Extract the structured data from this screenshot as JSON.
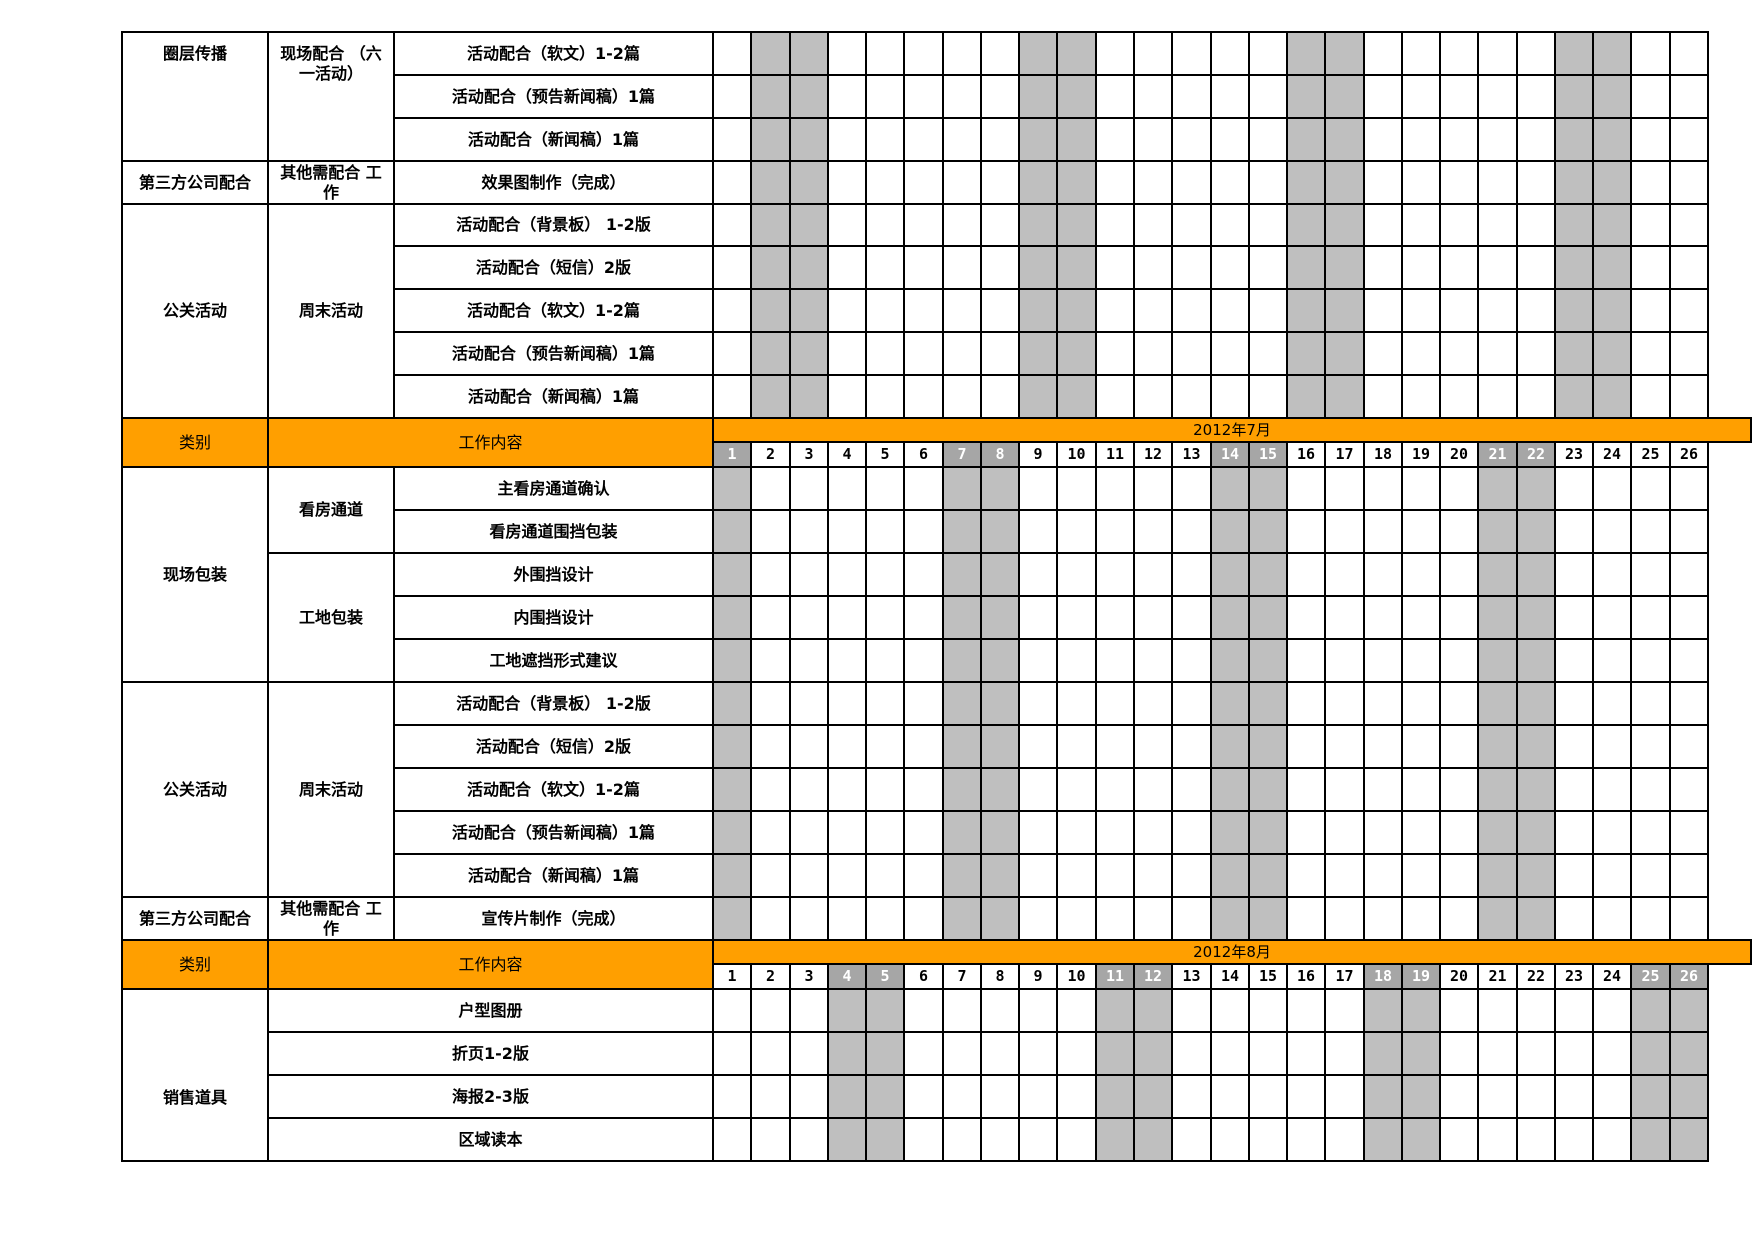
{
  "colors": {
    "header_orange": "#FF9F00",
    "weekend_shade": "#BFBFBF",
    "weekend_number_bg": "#A6A6A6",
    "weekend_number_text": "#FFFFFF",
    "grid_border": "#000000",
    "cell_bg": "#FFFFFF",
    "text": "#000000"
  },
  "days_per_month_shown": 26,
  "sections": [
    {
      "id": "june-body",
      "type": "body",
      "shaded_days": [
        2,
        3,
        9,
        10,
        16,
        17,
        23,
        24
      ],
      "groups": [
        {
          "category": "圈层传播",
          "category_align": "top",
          "subgroups": [
            {
              "label": "现场配合 （六一活动）",
              "align": "top",
              "tasks": [
                "活动配合（软文）1-2篇",
                "活动配合（预告新闻稿）1篇",
                "活动配合（新闻稿）1篇"
              ]
            }
          ]
        },
        {
          "category": "第三方公司配合",
          "subgroups": [
            {
              "label": "其他需配合 工作",
              "tasks": [
                "效果图制作（完成）"
              ]
            }
          ]
        },
        {
          "category": "公关活动",
          "subgroups": [
            {
              "label": "周末活动",
              "tasks": [
                "活动配合（背景板） 1-2版",
                "活动配合（短信）2版",
                "活动配合（软文）1-2篇",
                "活动配合（预告新闻稿）1篇",
                "活动配合（新闻稿）1篇"
              ]
            }
          ]
        }
      ]
    },
    {
      "id": "july-header",
      "type": "header",
      "category_label": "类别",
      "content_label": "工作内容",
      "month_label": "2012年7月",
      "days": [
        1,
        2,
        3,
        4,
        5,
        6,
        7,
        8,
        9,
        10,
        11,
        12,
        13,
        14,
        15,
        16,
        17,
        18,
        19,
        20,
        21,
        22,
        23,
        24,
        25,
        26
      ],
      "weekend_days": [
        1,
        7,
        8,
        14,
        15,
        21,
        22
      ]
    },
    {
      "id": "july-body",
      "type": "body",
      "shaded_days": [
        1,
        7,
        8,
        14,
        15,
        21,
        22
      ],
      "groups": [
        {
          "category": "现场包装",
          "subgroups": [
            {
              "label": "看房通道",
              "tasks": [
                "主看房通道确认",
                "看房通道围挡包装"
              ]
            },
            {
              "label": "工地包装",
              "tasks": [
                "外围挡设计",
                "内围挡设计",
                "工地遮挡形式建议"
              ]
            }
          ]
        },
        {
          "category": "公关活动",
          "subgroups": [
            {
              "label": "周末活动",
              "tasks": [
                "活动配合（背景板） 1-2版",
                "活动配合（短信）2版",
                "活动配合（软文）1-2篇",
                "活动配合（预告新闻稿）1篇",
                "活动配合（新闻稿）1篇"
              ]
            }
          ]
        },
        {
          "category": "第三方公司配合",
          "subgroups": [
            {
              "label": "其他需配合 工作",
              "tasks": [
                "宣传片制作（完成）"
              ]
            }
          ]
        }
      ]
    },
    {
      "id": "august-header",
      "type": "header",
      "category_label": "类别",
      "content_label": "工作内容",
      "month_label": "2012年8月",
      "days": [
        1,
        2,
        3,
        4,
        5,
        6,
        7,
        8,
        9,
        10,
        11,
        12,
        13,
        14,
        15,
        16,
        17,
        18,
        19,
        20,
        21,
        22,
        23,
        24,
        25,
        26
      ],
      "weekend_days": [
        4,
        5,
        11,
        12,
        18,
        19,
        25,
        26
      ]
    },
    {
      "id": "august-body",
      "type": "body",
      "shaded_days": [
        4,
        5,
        11,
        12,
        18,
        19,
        25,
        26
      ],
      "groups": [
        {
          "category": "销售道具",
          "category_align": "low",
          "subgroups": [
            {
              "label": "",
              "merged": true,
              "tasks": [
                "户型图册",
                "折页1-2版",
                "海报2-3版",
                "区域读本"
              ]
            }
          ]
        }
      ]
    }
  ]
}
